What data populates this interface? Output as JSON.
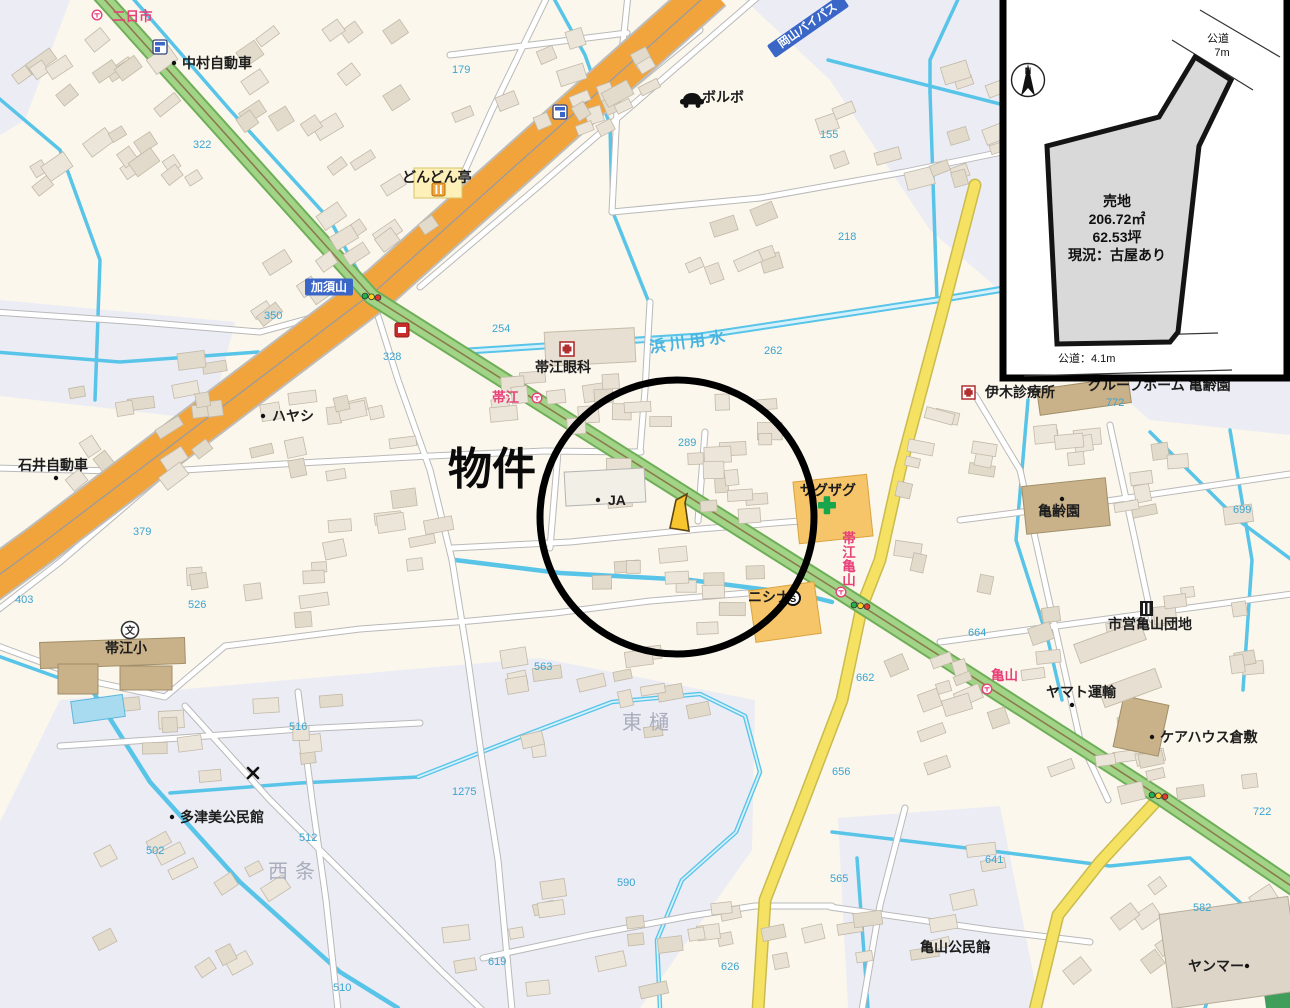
{
  "property": {
    "label": "物件"
  },
  "inset": {
    "north_label": "N",
    "land_label": "売地",
    "area_m2": "206.72㎡",
    "area_tsubo": "62.53坪",
    "status": "現況：古屋あり",
    "road_top_line1": "公道",
    "road_top_line2": "7m",
    "road_bottom": "公道：4.1m"
  },
  "palette": {
    "accent_circle": "#000000",
    "parcel_fill": "#f7c52e",
    "inset_parcel_fill": "#d9d9d9",
    "road_orange": "#f2a43c",
    "road_green": "#a2d487",
    "road_yellow": "#f5e262",
    "water_blue": "#58c4e8",
    "label_blue": "#3aa4d2",
    "label_red": "#e8417a",
    "banner_blue": "#3a66c8",
    "pharmacy_green": "#17a64b"
  },
  "icons": {
    "bus-stop": "circle with T mark",
    "traffic-light": "three dots green-yellow-red",
    "hospital": "white square with red cross",
    "school": "circle with 文",
    "convenience-store-blue": "blue square shop",
    "convenience-store-red": "red square shop",
    "restaurant": "fork and knife square",
    "car-dealer": "black car silhouette",
    "supermarket": "circled S",
    "pharmacy-cross": "green cross",
    "housing-complex": "black building block",
    "north-arrow": "compass needle N",
    "x-mark": "small x cross"
  },
  "labels": {
    "pois": [
      {
        "t": "中村自動車",
        "x": 182,
        "y": 68,
        "s": 15,
        "dot": [
          174,
          63
        ]
      },
      {
        "t": "ボルボ",
        "x": 702,
        "y": 102,
        "s": 14
      },
      {
        "t": "どんどん亭",
        "x": 402,
        "y": 182,
        "s": 13
      },
      {
        "t": "帯江眼科",
        "x": 535,
        "y": 372,
        "s": 14
      },
      {
        "t": "ハヤシ",
        "x": 272,
        "y": 421,
        "s": 13,
        "dot": [
          263,
          416
        ]
      },
      {
        "t": "石井自動車",
        "x": 18,
        "y": 470,
        "s": 14,
        "dot": [
          56,
          478
        ]
      },
      {
        "t": "JA",
        "x": 608,
        "y": 505,
        "s": 13,
        "dot": [
          598,
          500
        ]
      },
      {
        "t": "ザグザグ",
        "x": 800,
        "y": 495,
        "s": 12.5
      },
      {
        "t": "ニシナ",
        "x": 748,
        "y": 602,
        "s": 12.5
      },
      {
        "t": "伊木診療所",
        "x": 985,
        "y": 397,
        "s": 14
      },
      {
        "t": "亀齢園",
        "x": 1038,
        "y": 516,
        "s": 14,
        "dot": [
          1062,
          499
        ]
      },
      {
        "t": "市営亀山団地",
        "x": 1108,
        "y": 629,
        "s": 13.5
      },
      {
        "t": "ヤマト運輸",
        "x": 1046,
        "y": 697,
        "s": 13,
        "dot": [
          1072,
          705
        ]
      },
      {
        "t": "ケアハウス倉敷",
        "x": 1160,
        "y": 742,
        "s": 13,
        "dot": [
          1152,
          737
        ]
      },
      {
        "t": "多津美公民館",
        "x": 180,
        "y": 822,
        "s": 13,
        "dot": [
          172,
          817
        ]
      },
      {
        "t": "亀山公民館",
        "x": 920,
        "y": 952,
        "s": 13,
        "dot": [
          988,
          948
        ]
      },
      {
        "t": "ヤンマー",
        "x": 1188,
        "y": 971,
        "s": 14,
        "dot": [
          1247,
          966
        ]
      },
      {
        "t": "帯江小",
        "x": 105,
        "y": 653,
        "s": 15
      }
    ],
    "numbers": [
      [
        "322",
        193,
        148
      ],
      [
        "179",
        452,
        73
      ],
      [
        "155",
        820,
        138
      ],
      [
        "218",
        838,
        240
      ],
      [
        "350",
        264,
        319
      ],
      [
        "328",
        383,
        360
      ],
      [
        "254",
        492,
        332
      ],
      [
        "262",
        764,
        354
      ],
      [
        "289",
        678,
        446
      ],
      [
        "699",
        1233,
        513
      ],
      [
        "772",
        1106,
        406
      ],
      [
        "664",
        968,
        636
      ],
      [
        "662",
        856,
        681
      ],
      [
        "656",
        832,
        775
      ],
      [
        "641",
        985,
        863
      ],
      [
        "565",
        830,
        882
      ],
      [
        "582",
        1193,
        911
      ],
      [
        "722",
        1253,
        815
      ],
      [
        "626",
        721,
        970
      ],
      [
        "619",
        488,
        965
      ],
      [
        "590",
        617,
        886
      ],
      [
        "1275",
        452,
        795
      ],
      [
        "563",
        534,
        670
      ],
      [
        "526",
        188,
        608
      ],
      [
        "403",
        15,
        603
      ],
      [
        "379",
        133,
        535
      ],
      [
        "516",
        289,
        730
      ],
      [
        "512",
        299,
        841
      ],
      [
        "502",
        146,
        854
      ],
      [
        "510",
        333,
        991
      ]
    ],
    "red": [
      {
        "t": "二日市",
        "x": 112,
        "y": 21,
        "bus": [
          97,
          15
        ]
      },
      {
        "t": "帯江",
        "x": 492,
        "y": 402,
        "bus": [
          537,
          398
        ]
      },
      {
        "t": "亀山",
        "x": 991,
        "y": 680,
        "bus": [
          987,
          689
        ]
      }
    ],
    "vertical_red": {
      "t": "帯江亀山",
      "x": 849,
      "y": 543,
      "step": 14,
      "bus": [
        841,
        592
      ]
    },
    "banners": [
      {
        "t": "加須山",
        "x": 329,
        "y": 287,
        "w": 48,
        "h": 17,
        "rot": 0,
        "fs": 12
      },
      {
        "t": "岡山バイパス",
        "x": 808,
        "y": 26,
        "w": 90,
        "h": 15,
        "rot": -35,
        "fs": 11.5
      }
    ],
    "waterway": {
      "t": "浜川用水",
      "x": 690,
      "y": 347,
      "rot": -8
    },
    "areas": [
      {
        "t": "東樋",
        "x": 622,
        "y": 729
      },
      {
        "t": "西条",
        "x": 268,
        "y": 878
      }
    ],
    "clipped": {
      "t": "グループホーム 亀齢園",
      "x": 1088,
      "y": 390
    }
  }
}
